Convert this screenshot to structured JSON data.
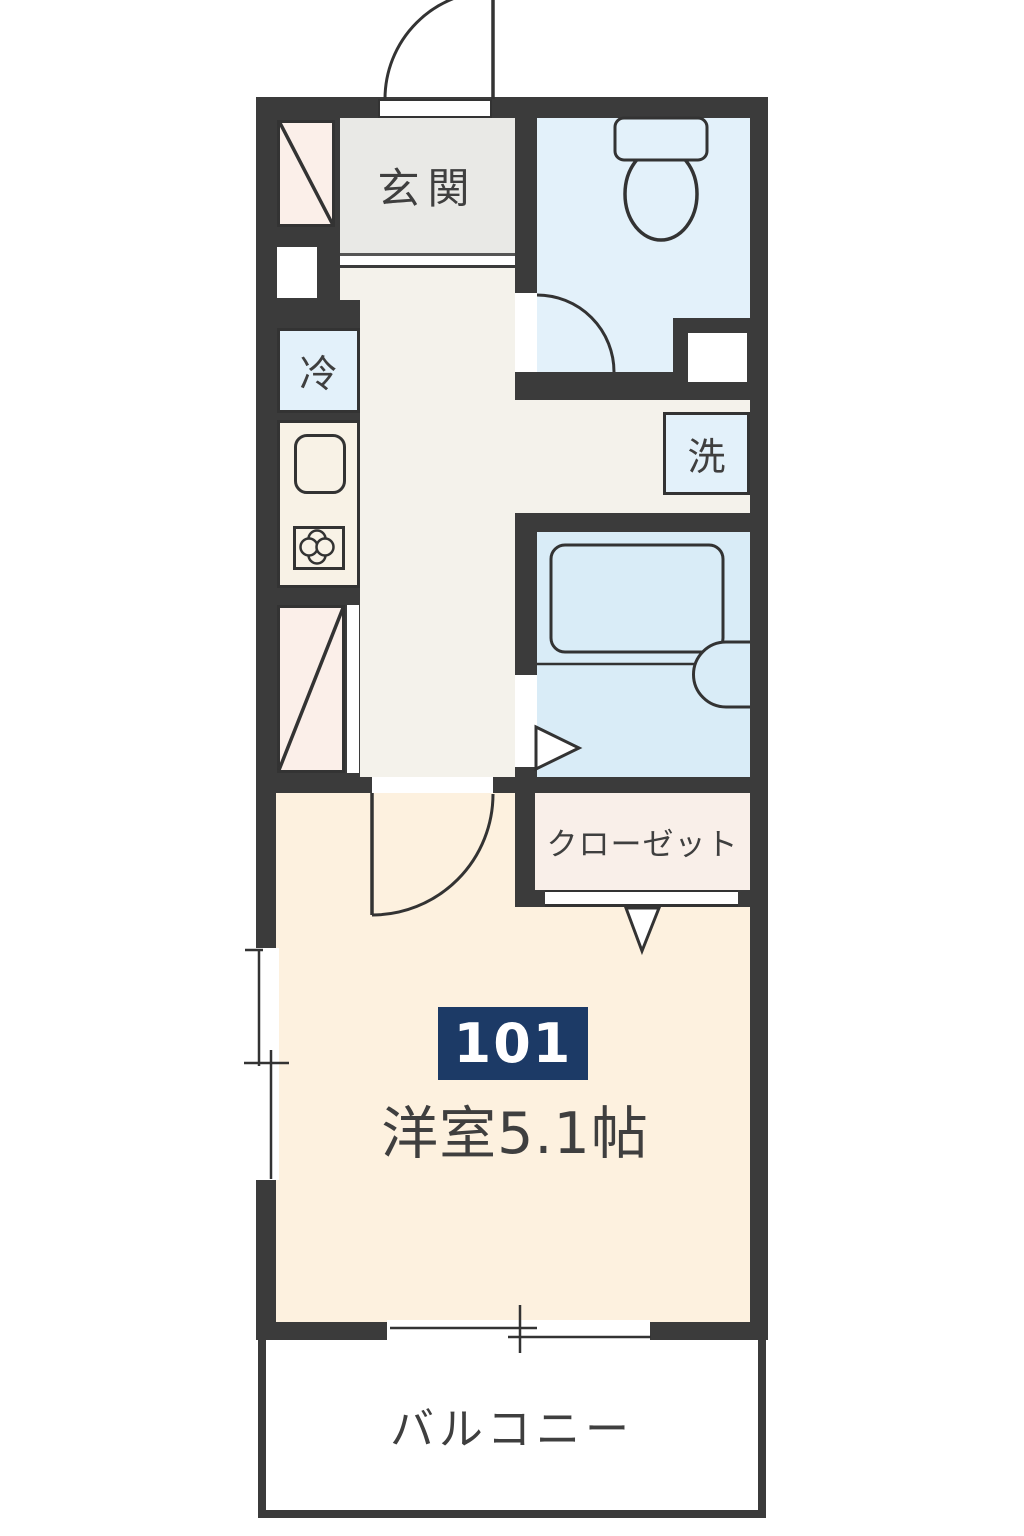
{
  "floor_plan": {
    "unit_number": "101",
    "labels": {
      "entrance": "玄関",
      "refrigerator": "冷",
      "washer": "洗",
      "closet": "クローゼット",
      "main_room": "洋室5.1帖",
      "balcony": "バルコニー"
    },
    "colors": {
      "wall": "#3b3b3b",
      "cream": "#fdf1df",
      "corridor": "#f4f2eb",
      "genkan": "#e9e9e6",
      "water": "#e3f1fa",
      "bath": "#d9ecf7",
      "pink": "#fbefe9",
      "closet": "#f9efe9",
      "counter": "#f8f2e6",
      "navy": "#1c3a66",
      "line": "#333333",
      "text": "#3f3f3f"
    }
  }
}
